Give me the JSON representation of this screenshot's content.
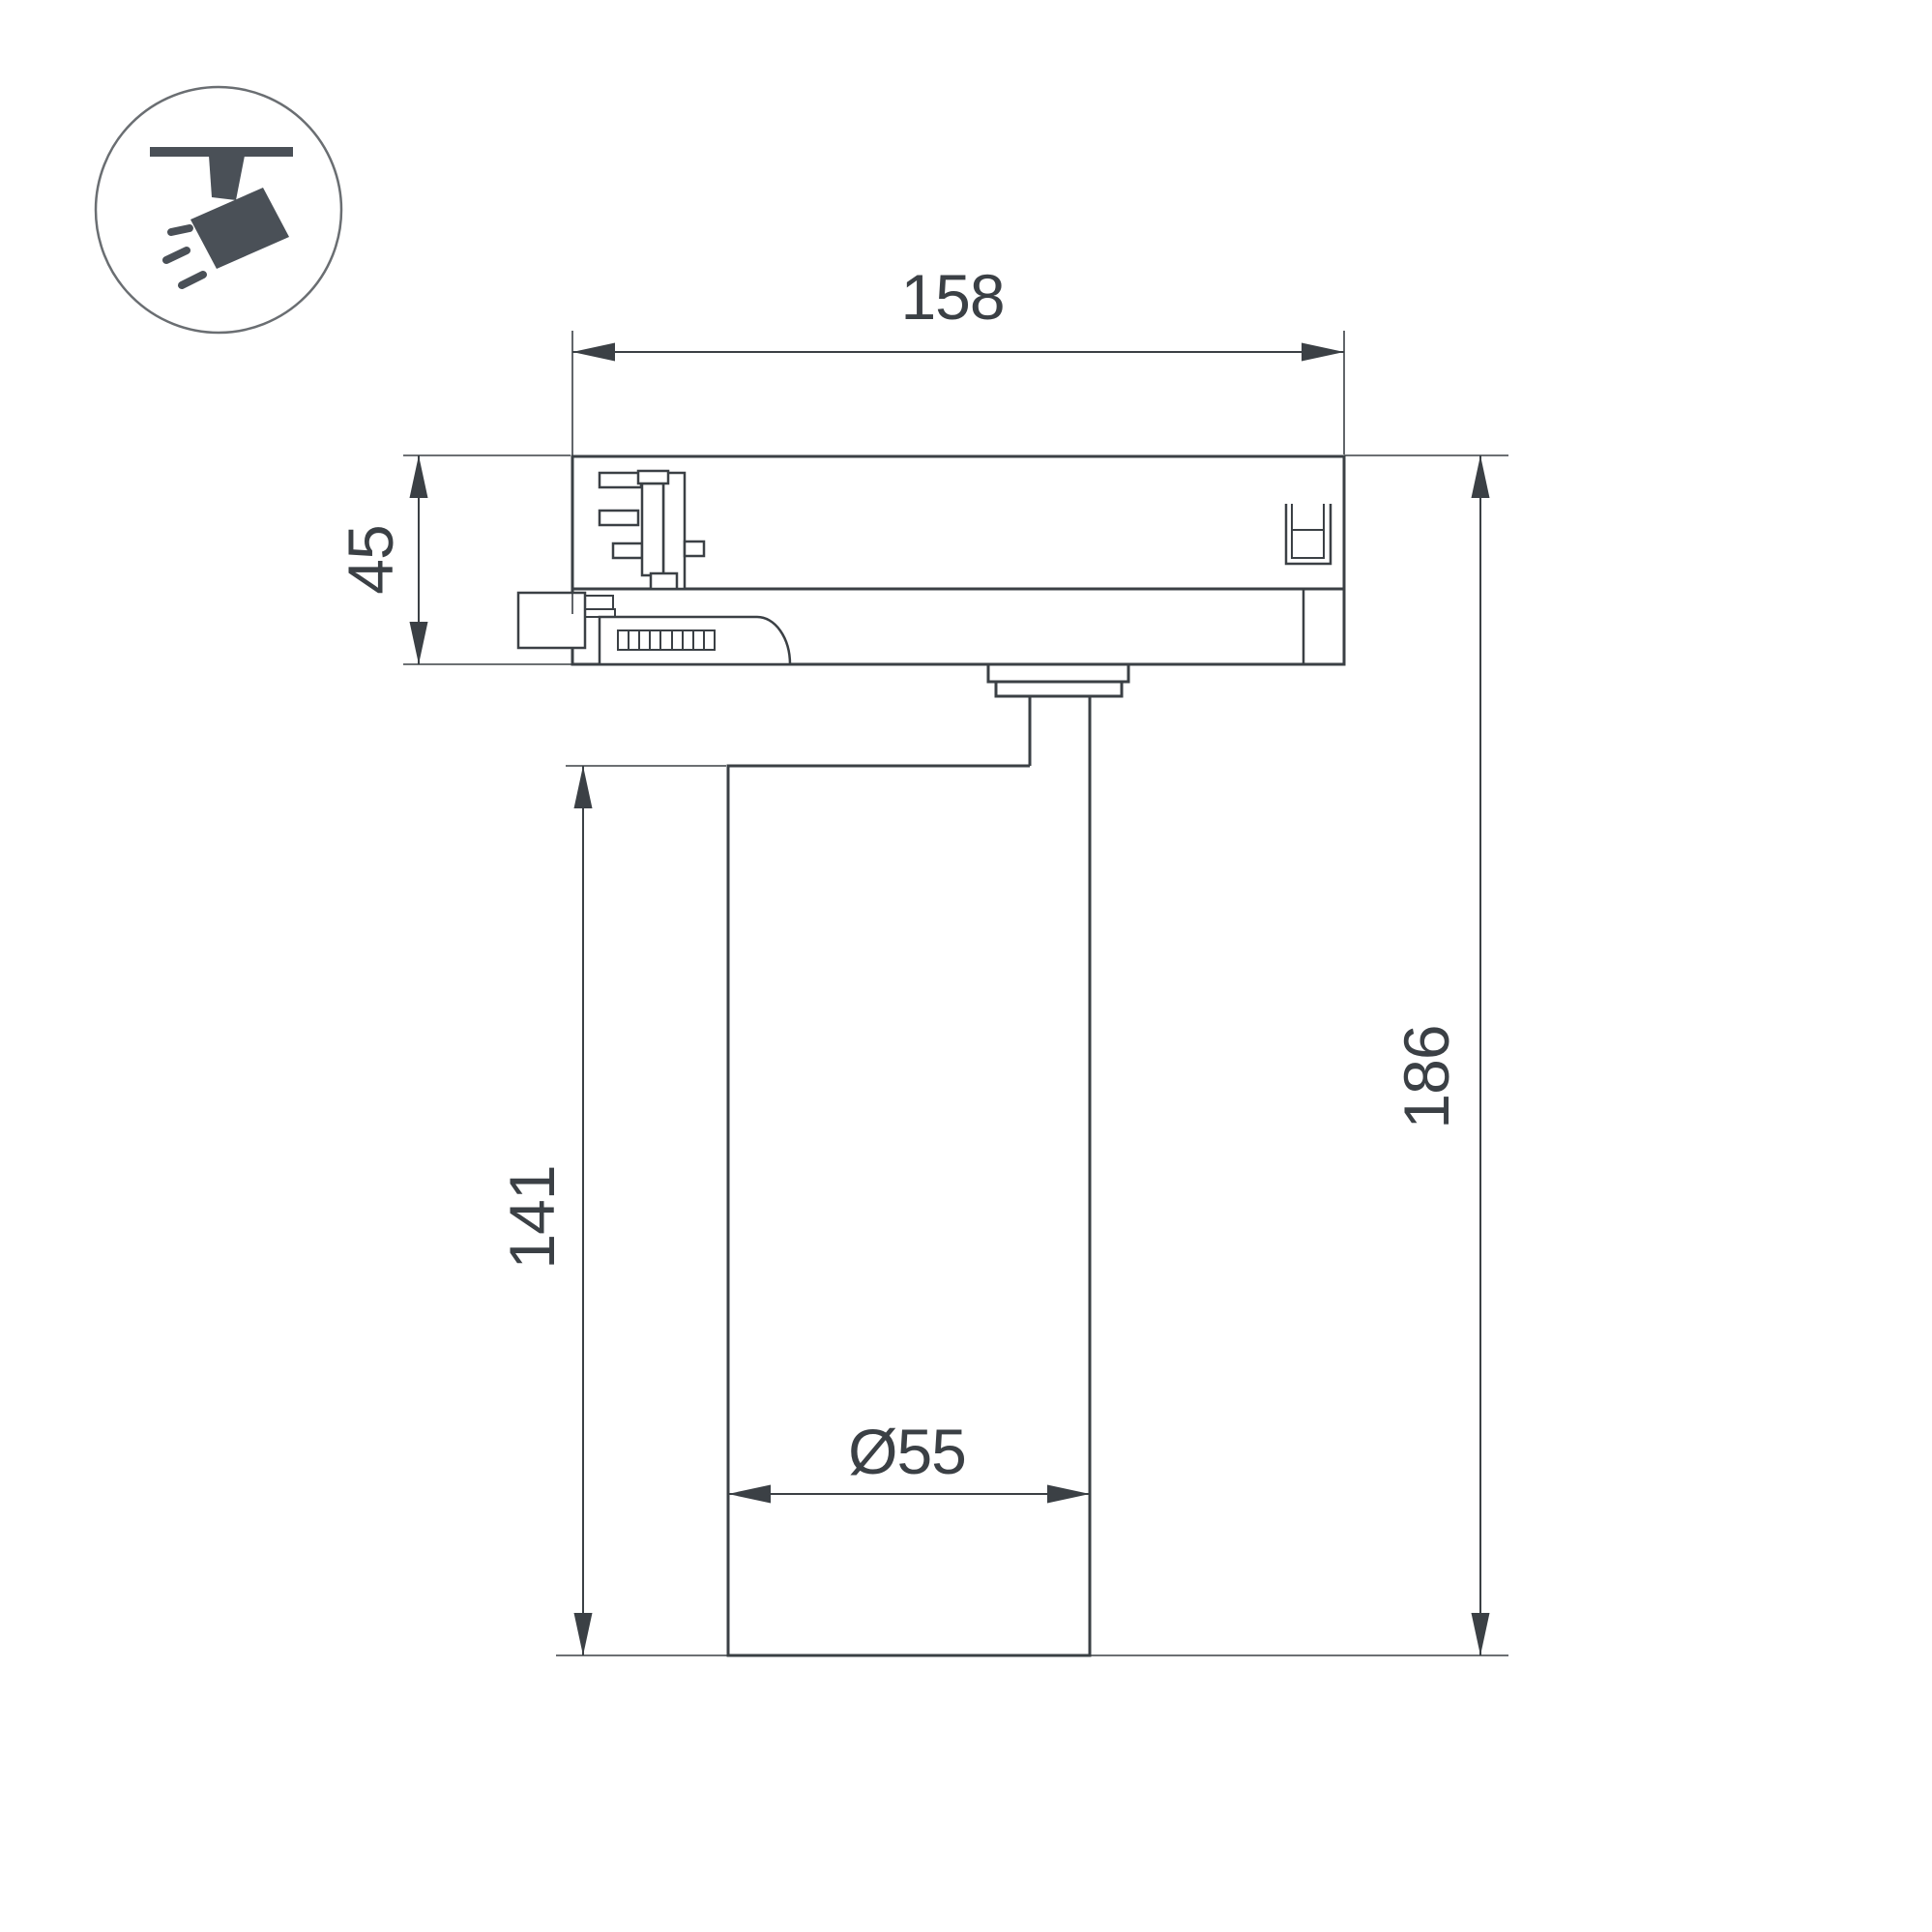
{
  "window": {
    "background": "#ffffff"
  },
  "icon": {
    "name": "ceiling-track-spotlight-icon",
    "glyph_color": "#4a5057",
    "ring_color": "#6a6e72"
  },
  "drawing": {
    "type": "technical-dimension-drawing",
    "line_color": "#3b4045",
    "dimensions": {
      "adapter_width": "158",
      "adapter_height": "45",
      "body_height": "141",
      "total_height": "186",
      "body_diameter": "Ø55"
    }
  }
}
